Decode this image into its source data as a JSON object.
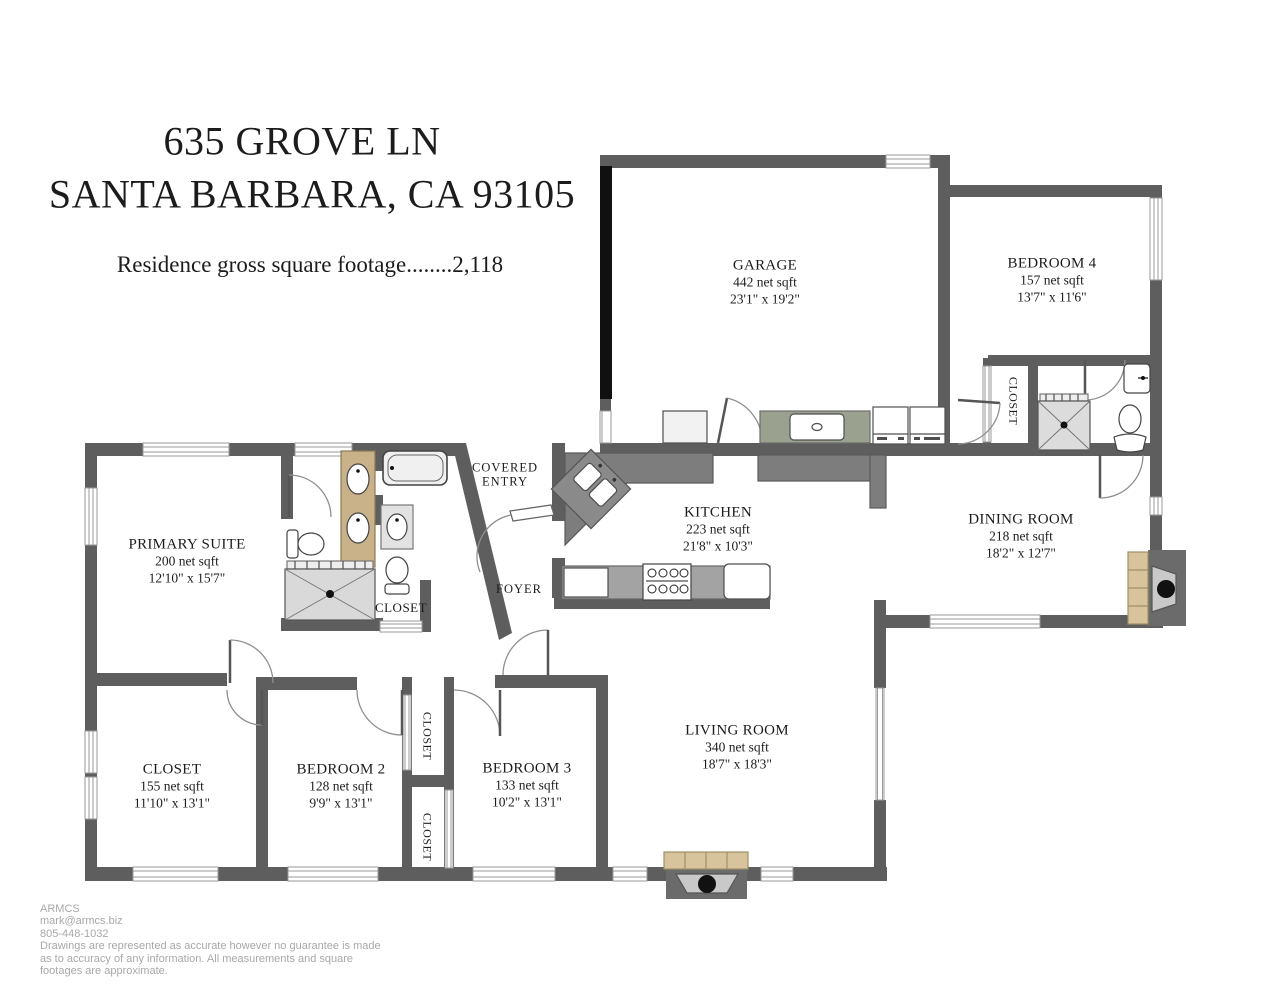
{
  "title": {
    "address_line1": "635 GROVE LN",
    "address_line2": "SANTA BARBARA, CA 93105",
    "sqft_line": "Residence gross square footage........2,118"
  },
  "rooms": {
    "garage": {
      "name": "GARAGE",
      "area": "442 net sqft",
      "dims": "23'1\" x 19'2\""
    },
    "bedroom4": {
      "name": "BEDROOM 4",
      "area": "157 net sqft",
      "dims": "13'7\" x 11'6\""
    },
    "kitchen": {
      "name": "KITCHEN",
      "area": "223 net sqft",
      "dims": "21'8\" x 10'3\""
    },
    "dining_room": {
      "name": "DINING ROOM",
      "area": "218 net sqft",
      "dims": "18'2\" x 12'7\""
    },
    "primary_suite": {
      "name": "PRIMARY SUITE",
      "area": "200 net sqft",
      "dims": "12'10\" x 15'7\""
    },
    "closet_room": {
      "name": "CLOSET",
      "area": "155 net sqft",
      "dims": "11'10\" x 13'1\""
    },
    "bedroom2": {
      "name": "BEDROOM 2",
      "area": "128 net sqft",
      "dims": "9'9\" x 13'1\""
    },
    "bedroom3": {
      "name": "BEDROOM 3",
      "area": "133 net sqft",
      "dims": "10'2\" x 13'1\""
    },
    "living_room": {
      "name": "LIVING ROOM",
      "area": "340 net sqft",
      "dims": "18'7\" x 18'3\""
    }
  },
  "labels": {
    "covered_entry_line1": "COVERED",
    "covered_entry_line2": "ENTRY",
    "foyer": "FOYER",
    "closet": "CLOSET"
  },
  "footer": {
    "company": "ARMCS",
    "email": "mark@armcs.biz",
    "phone": "805-448-1032",
    "disclaimer_line1": "Drawings are represented as accurate however no guarantee is made",
    "disclaimer_line2": "as to accuracy of any information. All measurements and square",
    "disclaimer_line3": "footages are approximate."
  },
  "colors": {
    "wall": "#5e5e5e",
    "wall_black": "#101010",
    "counter": "#7d7d7d",
    "counter_light": "#a3a3a3",
    "laundry_counter": "#9aa18f",
    "tile_tan": "#d8c49c",
    "fireplace_gray": "#6b6b6b",
    "shower_gray": "#dcdcdc",
    "footer_text": "#a8a8a8"
  }
}
